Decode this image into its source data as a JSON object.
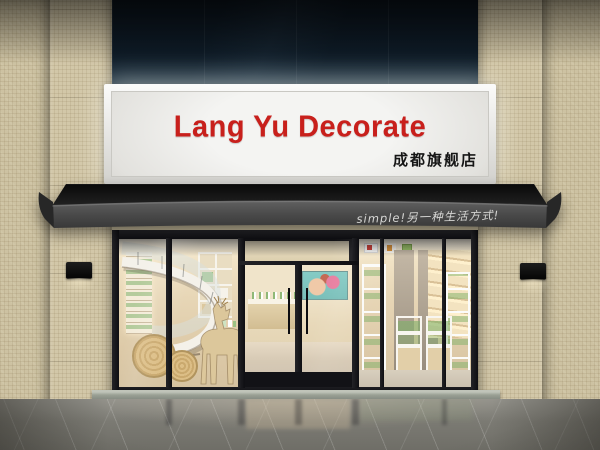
{
  "scene": {
    "kind": "storefront-photo-render",
    "store_name": "Lang Yu Decorate"
  },
  "signboard": {
    "title": "Lang Yu Decorate",
    "title_color": "#c8201c",
    "subtitle": "成都旗舰店",
    "subtitle_color": "#161616",
    "panel_color": "#e9e8e5"
  },
  "awning": {
    "slogan": "simple!另一种生活方式!",
    "slogan_color": "#d7d7d5",
    "fabric_color": "#4a4a4a",
    "underside_color": "#151515"
  },
  "facade": {
    "upper_glass_color": "#0d151e",
    "tile_color": "#cdc2a2",
    "frame_color": "#17171a",
    "lamp_color": "#101010"
  },
  "interior": {
    "wall_color": "#ecdcbd",
    "product_accent_color": "#7fb069",
    "staircase_color": "#f4f1ea",
    "deer_wood_color": "#dcc79b",
    "poster_color": "#85cbc5"
  },
  "exterior": {
    "floor_color": "#7b7a73",
    "step_color": "#a9aea4"
  }
}
